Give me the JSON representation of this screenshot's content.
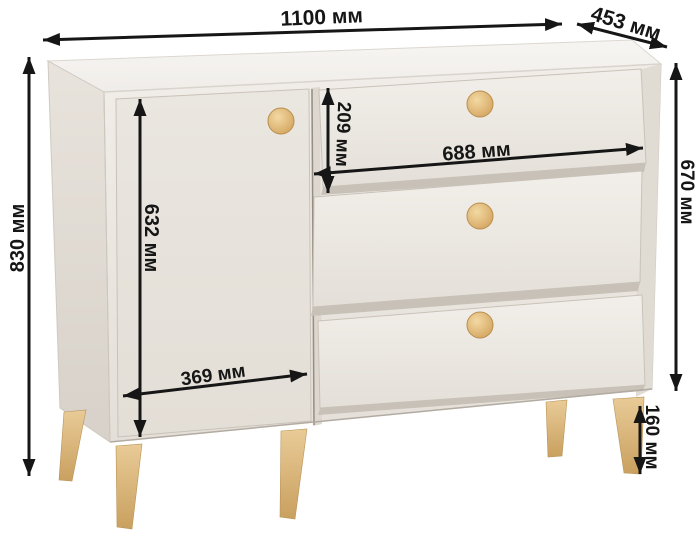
{
  "diagram": {
    "subject": "chest-of-drawers-dimension-diagram",
    "unit": "мм",
    "dimensions": {
      "overall_width": {
        "value": 1100,
        "label": "1100 мм"
      },
      "depth": {
        "value": 453,
        "label": "453 мм"
      },
      "overall_height": {
        "value": 830,
        "label": "830 мм"
      },
      "door_height": {
        "value": 632,
        "label": "632 мм"
      },
      "top_drawer_height": {
        "value": 209,
        "label": "209 мм"
      },
      "drawer_width": {
        "value": 688,
        "label": "688 мм"
      },
      "body_height": {
        "value": 670,
        "label": "670 мм"
      },
      "door_width": {
        "value": 369,
        "label": "369 мм"
      },
      "leg_height": {
        "value": 160,
        "label": "160 мм"
      }
    },
    "colors": {
      "background": "#ffffff",
      "dimension": "#161616",
      "body_front": "#ece7e1",
      "body_side": "#e2dcd5",
      "body_top": "#f5f3f0",
      "wood": "#ddb274"
    },
    "features": {
      "doors": 1,
      "drawers": 3,
      "knobs": 4,
      "legs": "tapered wood"
    }
  }
}
